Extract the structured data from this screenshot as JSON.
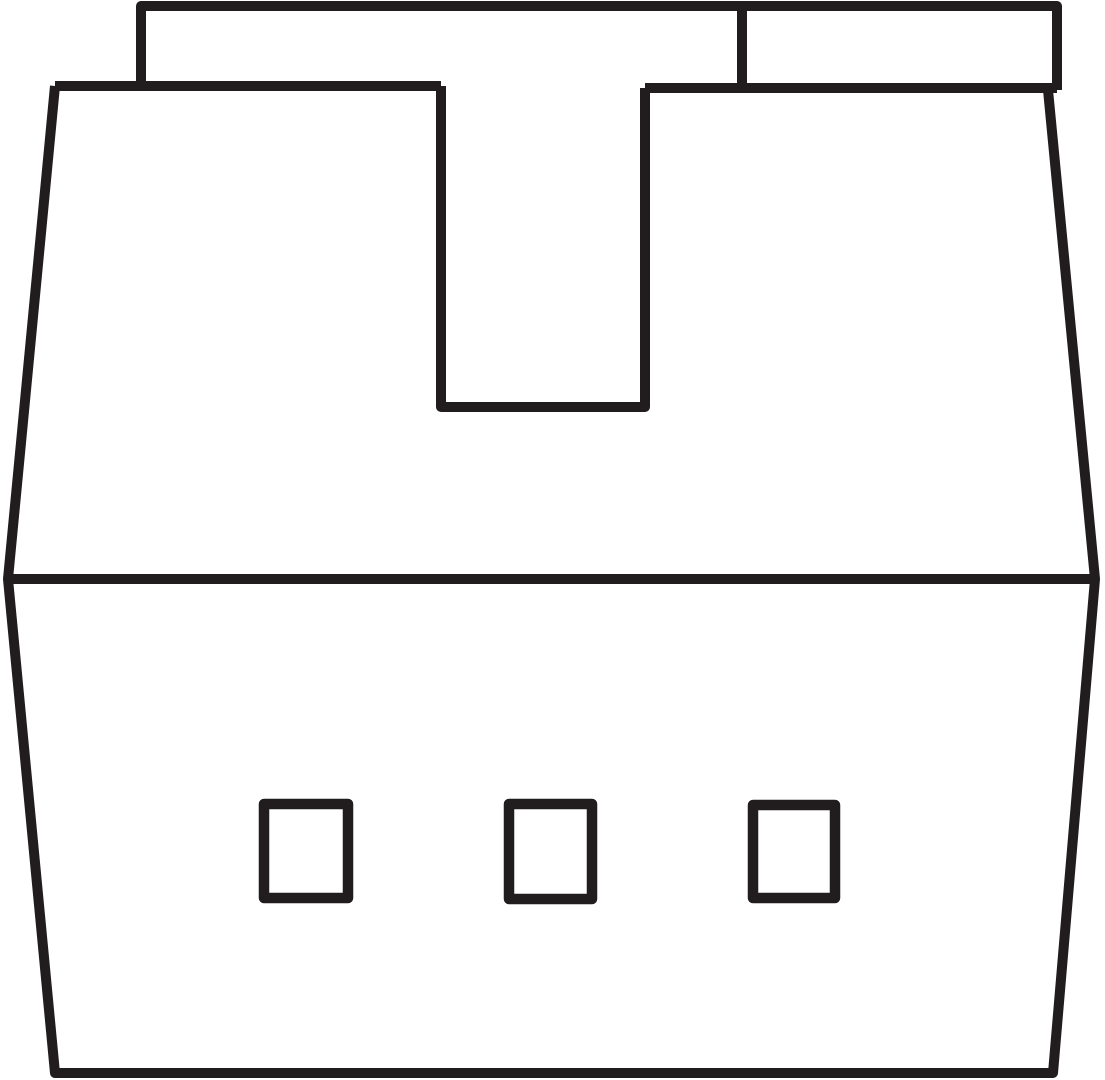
{
  "canvas": {
    "width": 1105,
    "height": 1080,
    "background": "#ffffff"
  },
  "figure": {
    "stroke_color": "#211d1e",
    "fill_color": "none",
    "stroke_width": 10,
    "linejoin": "round",
    "paths": [
      {
        "name": "latch-outline",
        "d": "M 141 88 L 141 6 L 1057 6 L 1057 90"
      },
      {
        "name": "latch-divider-line",
        "d": "M 742 6 L 742 88"
      },
      {
        "name": "housing-top-edge-left",
        "d": "M 55 86 L 441 86"
      },
      {
        "name": "housing-top-edge-right",
        "d": "M 645 88 L 1057 88"
      },
      {
        "name": "latch-slot-outline",
        "d": "M 441 86 L 441 407 L 645 407 L 645 88"
      },
      {
        "name": "housing-body-outline",
        "d": "M 55 86 L 8 579 L 55 1073 L 1053 1073 L 1095 579 L 1048 90"
      },
      {
        "name": "housing-parting-line",
        "d": "M 8 579 L 1095 579"
      },
      {
        "name": "pin-opening-left",
        "d": "M 264 804 L 348 804 L 348 898 L 264 898 Z",
        "stroke_width": 10.5
      },
      {
        "name": "pin-opening-middle",
        "d": "M 509 804 L 592 804 L 592 899 L 509 899 Z",
        "stroke_width": 10.5
      },
      {
        "name": "pin-opening-right",
        "d": "M 753 805 L 835 805 L 835 898 L 753 898 Z",
        "stroke_width": 10.5
      }
    ]
  }
}
